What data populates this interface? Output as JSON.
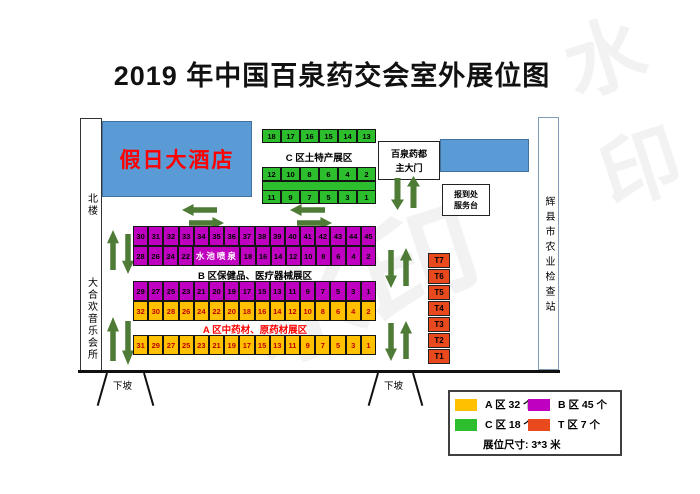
{
  "title": "2019 年中国百泉药交会室外展位图",
  "map": {
    "hotel_label": "假日大酒店",
    "north_building": "北楼",
    "music_club": "大合欢音乐会所",
    "inspection_station": "辉县市农业检查站",
    "main_gate": [
      "百泉药都",
      "主大门"
    ],
    "registration": [
      "报到处",
      "服务台"
    ],
    "fountain": "水池喷泉",
    "downhill_left": "下坡",
    "downhill_right": "下坡",
    "zone_labels": {
      "a": "A 区中药材、原药材展区",
      "b": "B 区保健品、医疗器械展区",
      "c": "C 区土特产展区"
    }
  },
  "booths": {
    "c_top": [
      "18",
      "17",
      "16",
      "15",
      "14",
      "13"
    ],
    "c_mid": [
      "12",
      "10",
      "8",
      "6",
      "4",
      "2"
    ],
    "c_bottom": [
      "11",
      "9",
      "7",
      "5",
      "3",
      "1"
    ],
    "b_row1": [
      "30",
      "31",
      "32",
      "33",
      "34",
      "35",
      "36",
      "37",
      "38",
      "39",
      "40",
      "41",
      "42",
      "43",
      "44",
      "45"
    ],
    "b_row2_left": [
      "28",
      "26",
      "24",
      "22"
    ],
    "b_row2_right": [
      "18",
      "16",
      "14",
      "12",
      "10",
      "8",
      "6",
      "4",
      "2"
    ],
    "b_row3": [
      "29",
      "27",
      "25",
      "23",
      "21",
      "20",
      "19",
      "17",
      "15",
      "13",
      "11",
      "9",
      "7",
      "5",
      "3",
      "1"
    ],
    "a_row1": [
      "32",
      "30",
      "28",
      "26",
      "24",
      "22",
      "20",
      "18",
      "16",
      "14",
      "12",
      "10",
      "8",
      "6",
      "4",
      "2"
    ],
    "a_row2": [
      "31",
      "29",
      "27",
      "25",
      "23",
      "21",
      "19",
      "17",
      "15",
      "13",
      "11",
      "9",
      "7",
      "5",
      "3",
      "1"
    ],
    "t_column": [
      "T7",
      "T6",
      "T5",
      "T4",
      "T3",
      "T2",
      "T1"
    ]
  },
  "legend": {
    "items": [
      {
        "label": "A 区 32 个"
      },
      {
        "label": "B 区 45 个"
      },
      {
        "label": "C 区 18 个"
      },
      {
        "label": "T 区 7 个"
      }
    ],
    "size_note": "展位尺寸: 3*3 米"
  },
  "colors": {
    "zoneA": "#FFC000",
    "zoneB": "#C000C0",
    "zoneC": "#2DBE2D",
    "zoneT": "#E8491D",
    "hotelBlue": "#5B9BD5",
    "arrowGreen": "#4E7B36",
    "hotelText": "#FF0000",
    "aCellText": "#C00000",
    "aLabelText": "#FF0000"
  },
  "watermark": "水印"
}
